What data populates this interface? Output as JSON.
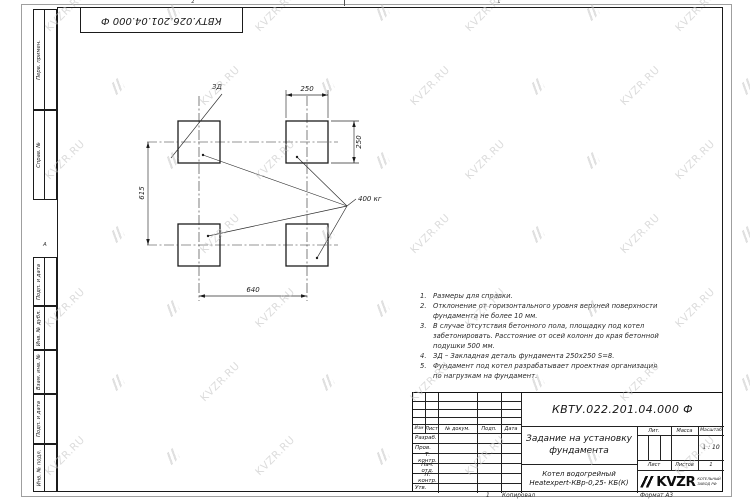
{
  "watermark": {
    "text": "KVZR.RU"
  },
  "stamp_top": {
    "number": "КВТУ.026.201.04.000 Ф"
  },
  "zones": {
    "top_right_num": "1",
    "top_left_num": "2",
    "left_letter": "А"
  },
  "margin_strips": [
    "Перв. примен.",
    "Справ. №",
    "Подп. и дата",
    "Инв. № дубл.",
    "Взам. инв. №",
    "Подп. и дата",
    "Инв. № подл."
  ],
  "drawing": {
    "zd_label": "ЗД",
    "load_label": "400 кг",
    "dim_top": "250",
    "dim_right": "250",
    "dim_left": "615",
    "dim_bottom": "640"
  },
  "notes": {
    "items": [
      {
        "num": "1.",
        "text": "Размеры для справки."
      },
      {
        "num": "2.",
        "text": "Отклонение от горизонтального уровня верхней поверхности фундамента не более 10 мм."
      },
      {
        "num": "3.",
        "text": "В случае отсутствия бетонного пола, площадку под котел забетонировать. Расстояние от осей колонн до края бетонной подушки 500 мм."
      },
      {
        "num": "4.",
        "text": "ЗД – Закладная деталь фундамента 250х250 S=8."
      },
      {
        "num": "5.",
        "text": "Фундамент под котел разрабатывает проектная организация по нагрузкам на фундамент."
      }
    ]
  },
  "title_block": {
    "doc_number": "КВТУ.022.201.04.000 Ф",
    "title_line1": "Задание на установку",
    "title_line2": "фундамента",
    "product_line1": "Котел водогрейный",
    "product_line2": "Heatexpert-КВр-0,25- КБ(К)",
    "col_headers": [
      "Изм",
      "Лист",
      "№ докум.",
      "Подп.",
      "Дата"
    ],
    "sig_rows": [
      "Разраб.",
      "Пров.",
      "Т. контр.",
      "Нач. отд.",
      "Н. контр.",
      "Утв."
    ],
    "lit_label": "Лит.",
    "mass_label": "Масса",
    "scale_label": "Масштаб",
    "scale_value": "1 : 10",
    "sheet_label": "Лист",
    "sheets_label": "Листов",
    "sheets_value": "1",
    "logo_text": "KVZR",
    "logo_sub1": "КОТЕЛЬНЫЙ",
    "logo_sub2": "ЗАВОД РФ",
    "footer_num": "1",
    "footer_copied": "Копировал",
    "footer_format": "Формат А3"
  }
}
